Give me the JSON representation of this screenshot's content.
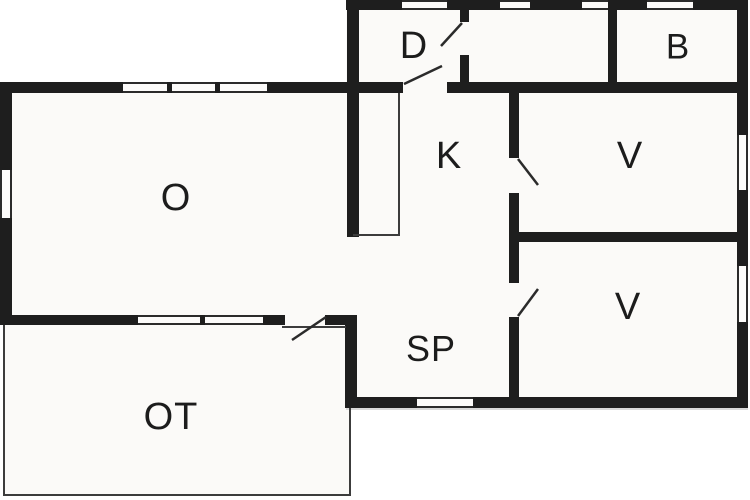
{
  "floorplan": {
    "title": "floor-plan",
    "rooms": [
      {
        "id": "o",
        "label": "O"
      },
      {
        "id": "ot",
        "label": "OT"
      },
      {
        "id": "sp",
        "label": "SP"
      },
      {
        "id": "k",
        "label": "K"
      },
      {
        "id": "d",
        "label": "D"
      },
      {
        "id": "b",
        "label": "B"
      },
      {
        "id": "v-upper",
        "label": "V"
      },
      {
        "id": "v-lower",
        "label": "V"
      }
    ],
    "colors": {
      "wall": "#1e1e1e",
      "floor": "#fbfaf8",
      "background": "#ffffff",
      "thin_line": "#3c3c3c",
      "label_text": "#1c1c1c"
    },
    "counts": {
      "window_openings": 13,
      "door_swings": 5
    }
  }
}
